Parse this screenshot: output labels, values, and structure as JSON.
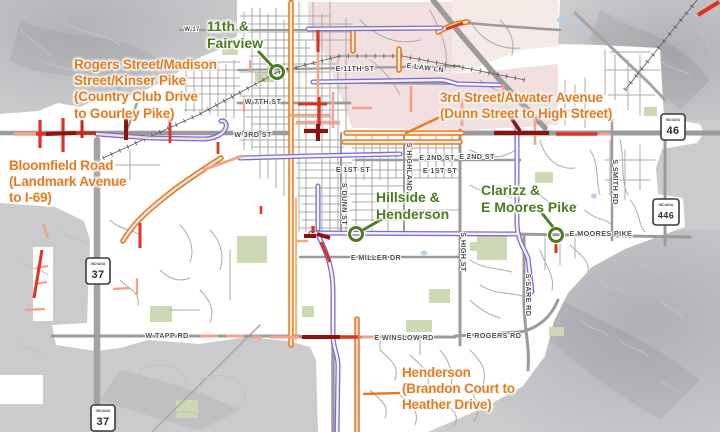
{
  "map": {
    "project_labels": [
      {
        "id": "rogers-kinser",
        "lines": [
          "Rogers Street/Madison",
          "Street/Kinser Pike",
          "(Country Club Drive",
          "to Gourley Pike)"
        ]
      },
      {
        "id": "bloomfield",
        "lines": [
          "Bloomfield Road",
          "(Landmark Avenue",
          "to I-69)"
        ]
      },
      {
        "id": "third-atwater",
        "lines": [
          "3rd Street/Atwater Avenue",
          "(Dunn Street to High Street)"
        ]
      },
      {
        "id": "henderson",
        "lines": [
          "Henderson",
          "(Brandon Court to",
          "Heather Drive)"
        ]
      }
    ],
    "intersection_labels": [
      {
        "id": "eleventh-fairview",
        "lines": [
          "11th &",
          "Fairview"
        ]
      },
      {
        "id": "hillside-henderson",
        "lines": [
          "Hillside &",
          "Henderson"
        ]
      },
      {
        "id": "clarizz-moores",
        "lines": [
          "Clarizz &",
          "E Moores Pike"
        ]
      }
    ],
    "street_labels": [
      "W 7TH ST",
      "W 3RD ST",
      "E 11TH ST",
      "E LAW LN",
      "E 2ND ST",
      "E 2ND ST",
      "E 1ST ST",
      "E 1ST ST",
      "E MILLER DR",
      "E MOORES PIKE",
      "W TAPP RD",
      "E WINSLOW RD",
      "E ROGERS RD",
      "S HIGHLAND",
      "S DUNN ST",
      "S HIGH ST",
      "S SARE RD",
      "S SMITH RD",
      "W 17"
    ],
    "shields": [
      {
        "state": "INDIANA",
        "number": "46"
      },
      {
        "state": "INDIANA",
        "number": "446"
      },
      {
        "state": "INDIANA",
        "number": "37"
      },
      {
        "state": "INDIANA",
        "number": "37"
      }
    ],
    "colors": {
      "project_label": "#E87A1E",
      "intersection_label": "#4C7C1F",
      "highlight_orange": "#E87A1E",
      "highlight_purple": "#7A6ED2",
      "condition_good": "#F2A488",
      "condition_fair": "#DD3322",
      "condition_poor": "#8C1210",
      "campus_area": "#F2DFDF",
      "city_area": "#FFFFFF",
      "county_area": "#CBCACD"
    }
  }
}
